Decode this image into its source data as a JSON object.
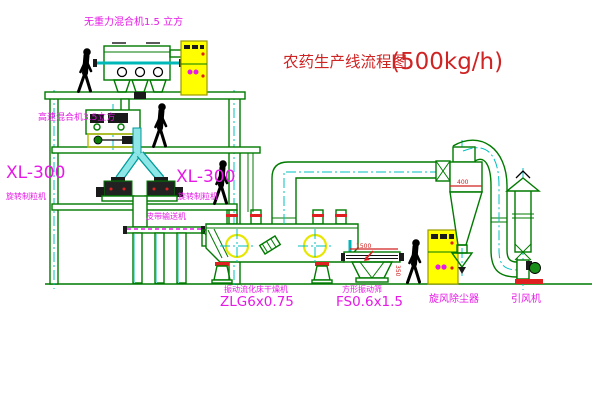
{
  "diagram": {
    "title": {
      "text_cn": "农药生产线流程图",
      "capacity": "(500kg/h)"
    },
    "equipment_labels": {
      "gravity_mixer": "无重力混合机1.5 立方",
      "high_speed_mixer": "高速混合机3.5立方",
      "granulator_left_model": "XL-300",
      "granulator_left_name": "旋转制粒机",
      "granulator_right_model": "XL-300",
      "granulator_right_name": "旋转制粒机",
      "belt_conveyor": "皮带输送机",
      "fluid_bed_dryer_name": "振动流化床干燥机",
      "fluid_bed_dryer_model": "ZLG6x0.75",
      "vibrating_screen_name": "方形振动筛",
      "vibrating_screen_model": "FS0.6x1.5",
      "cyclone": "旋风除尘器",
      "fan": "引风机"
    },
    "dimensions": {
      "screen_length": "1500",
      "screen_height": "350",
      "cyclone_note": "400"
    },
    "colors": {
      "line_green": "#007a00",
      "label_magenta": "#e619e6",
      "title_red": "#cf2424",
      "centerline_cyan": "#00bfbf",
      "cabinet_yellow": "#ffff00",
      "alert_red": "#e02020"
    }
  }
}
